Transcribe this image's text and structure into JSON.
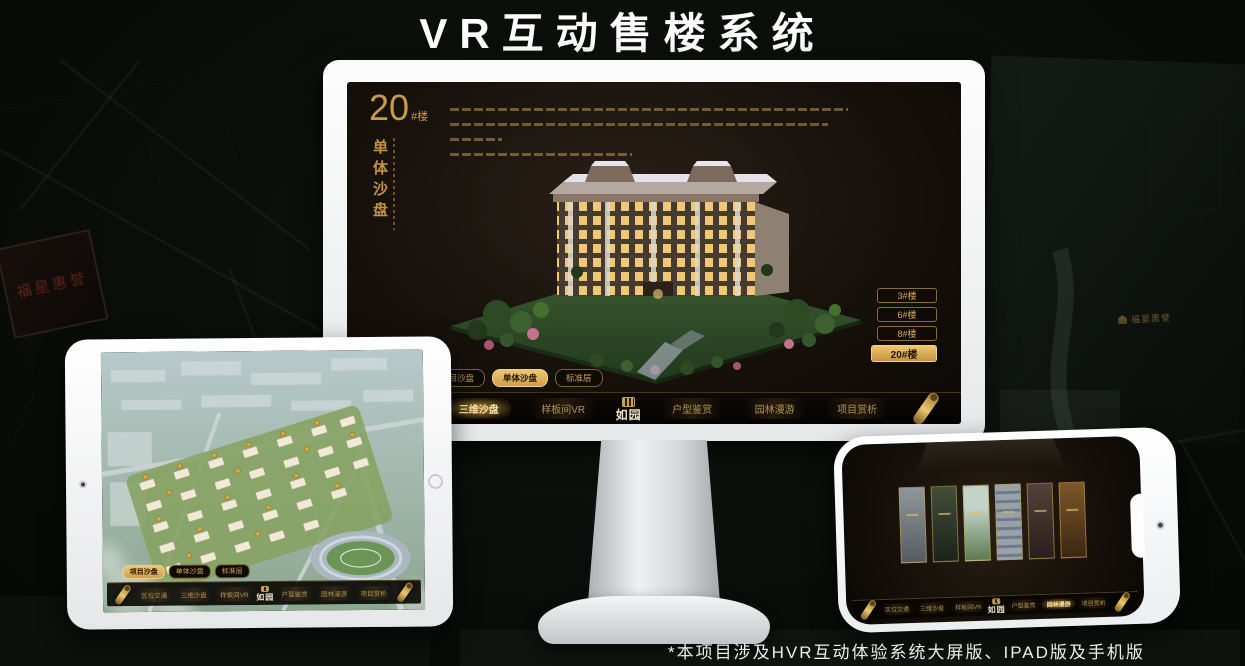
{
  "page": {
    "title": "VR互动售楼系统",
    "footnote": "*本项目涉及HVR互动体验系统大屏版、IPAD版及手机版"
  },
  "colors": {
    "accent_gold": "#d2a74f",
    "active_gold": "#eec672",
    "nav_text": "#b09257",
    "screen_bg": "#17110b",
    "title_white": "#ffffff"
  },
  "background": {
    "plaque_label": "福星惠誉",
    "brand_label": "福星惠誉"
  },
  "monitor": {
    "panel": {
      "building_number": "20",
      "building_unit": "#楼",
      "title_vertical": "单体沙盘"
    },
    "floor_buttons": [
      {
        "label": "3#楼",
        "active": false
      },
      {
        "label": "6#楼",
        "active": false
      },
      {
        "label": "8#楼",
        "active": false
      },
      {
        "label": "20#楼",
        "active": true
      }
    ],
    "sub_tabs": [
      {
        "label": "项目沙盘",
        "active": false
      },
      {
        "label": "单体沙盘",
        "active": true
      },
      {
        "label": "标准层",
        "active": false
      }
    ],
    "nav": {
      "logo_text": "如园",
      "items": [
        {
          "label": "区位交通",
          "active": false
        },
        {
          "label": "三维沙盘",
          "active": true
        },
        {
          "label": "样板间VR",
          "active": false
        },
        {
          "label": "户型鉴赏",
          "active": false
        },
        {
          "label": "园林漫游",
          "active": false
        },
        {
          "label": "项目赏析",
          "active": false
        }
      ]
    }
  },
  "tablet": {
    "sub_tabs": [
      {
        "label": "项目沙盘",
        "active": true
      },
      {
        "label": "单体沙盘",
        "active": false
      },
      {
        "label": "标准层",
        "active": false
      }
    ],
    "nav": {
      "logo_text": "如园",
      "items": [
        {
          "label": "区位交通",
          "active": false
        },
        {
          "label": "三维沙盘",
          "active": false
        },
        {
          "label": "样板间VR",
          "active": false
        },
        {
          "label": "户型鉴赏",
          "active": false
        },
        {
          "label": "园林漫游",
          "active": false
        },
        {
          "label": "项目赏析",
          "active": false
        }
      ]
    }
  },
  "phone": {
    "nav": {
      "logo_text": "如园",
      "items": [
        {
          "label": "区位交通",
          "active": false
        },
        {
          "label": "三维沙盘",
          "active": false
        },
        {
          "label": "样板间VR",
          "active": false
        },
        {
          "label": "户型鉴赏",
          "active": false
        },
        {
          "label": "园林漫游",
          "active": true
        },
        {
          "label": "项目赏析",
          "active": false
        }
      ]
    }
  }
}
